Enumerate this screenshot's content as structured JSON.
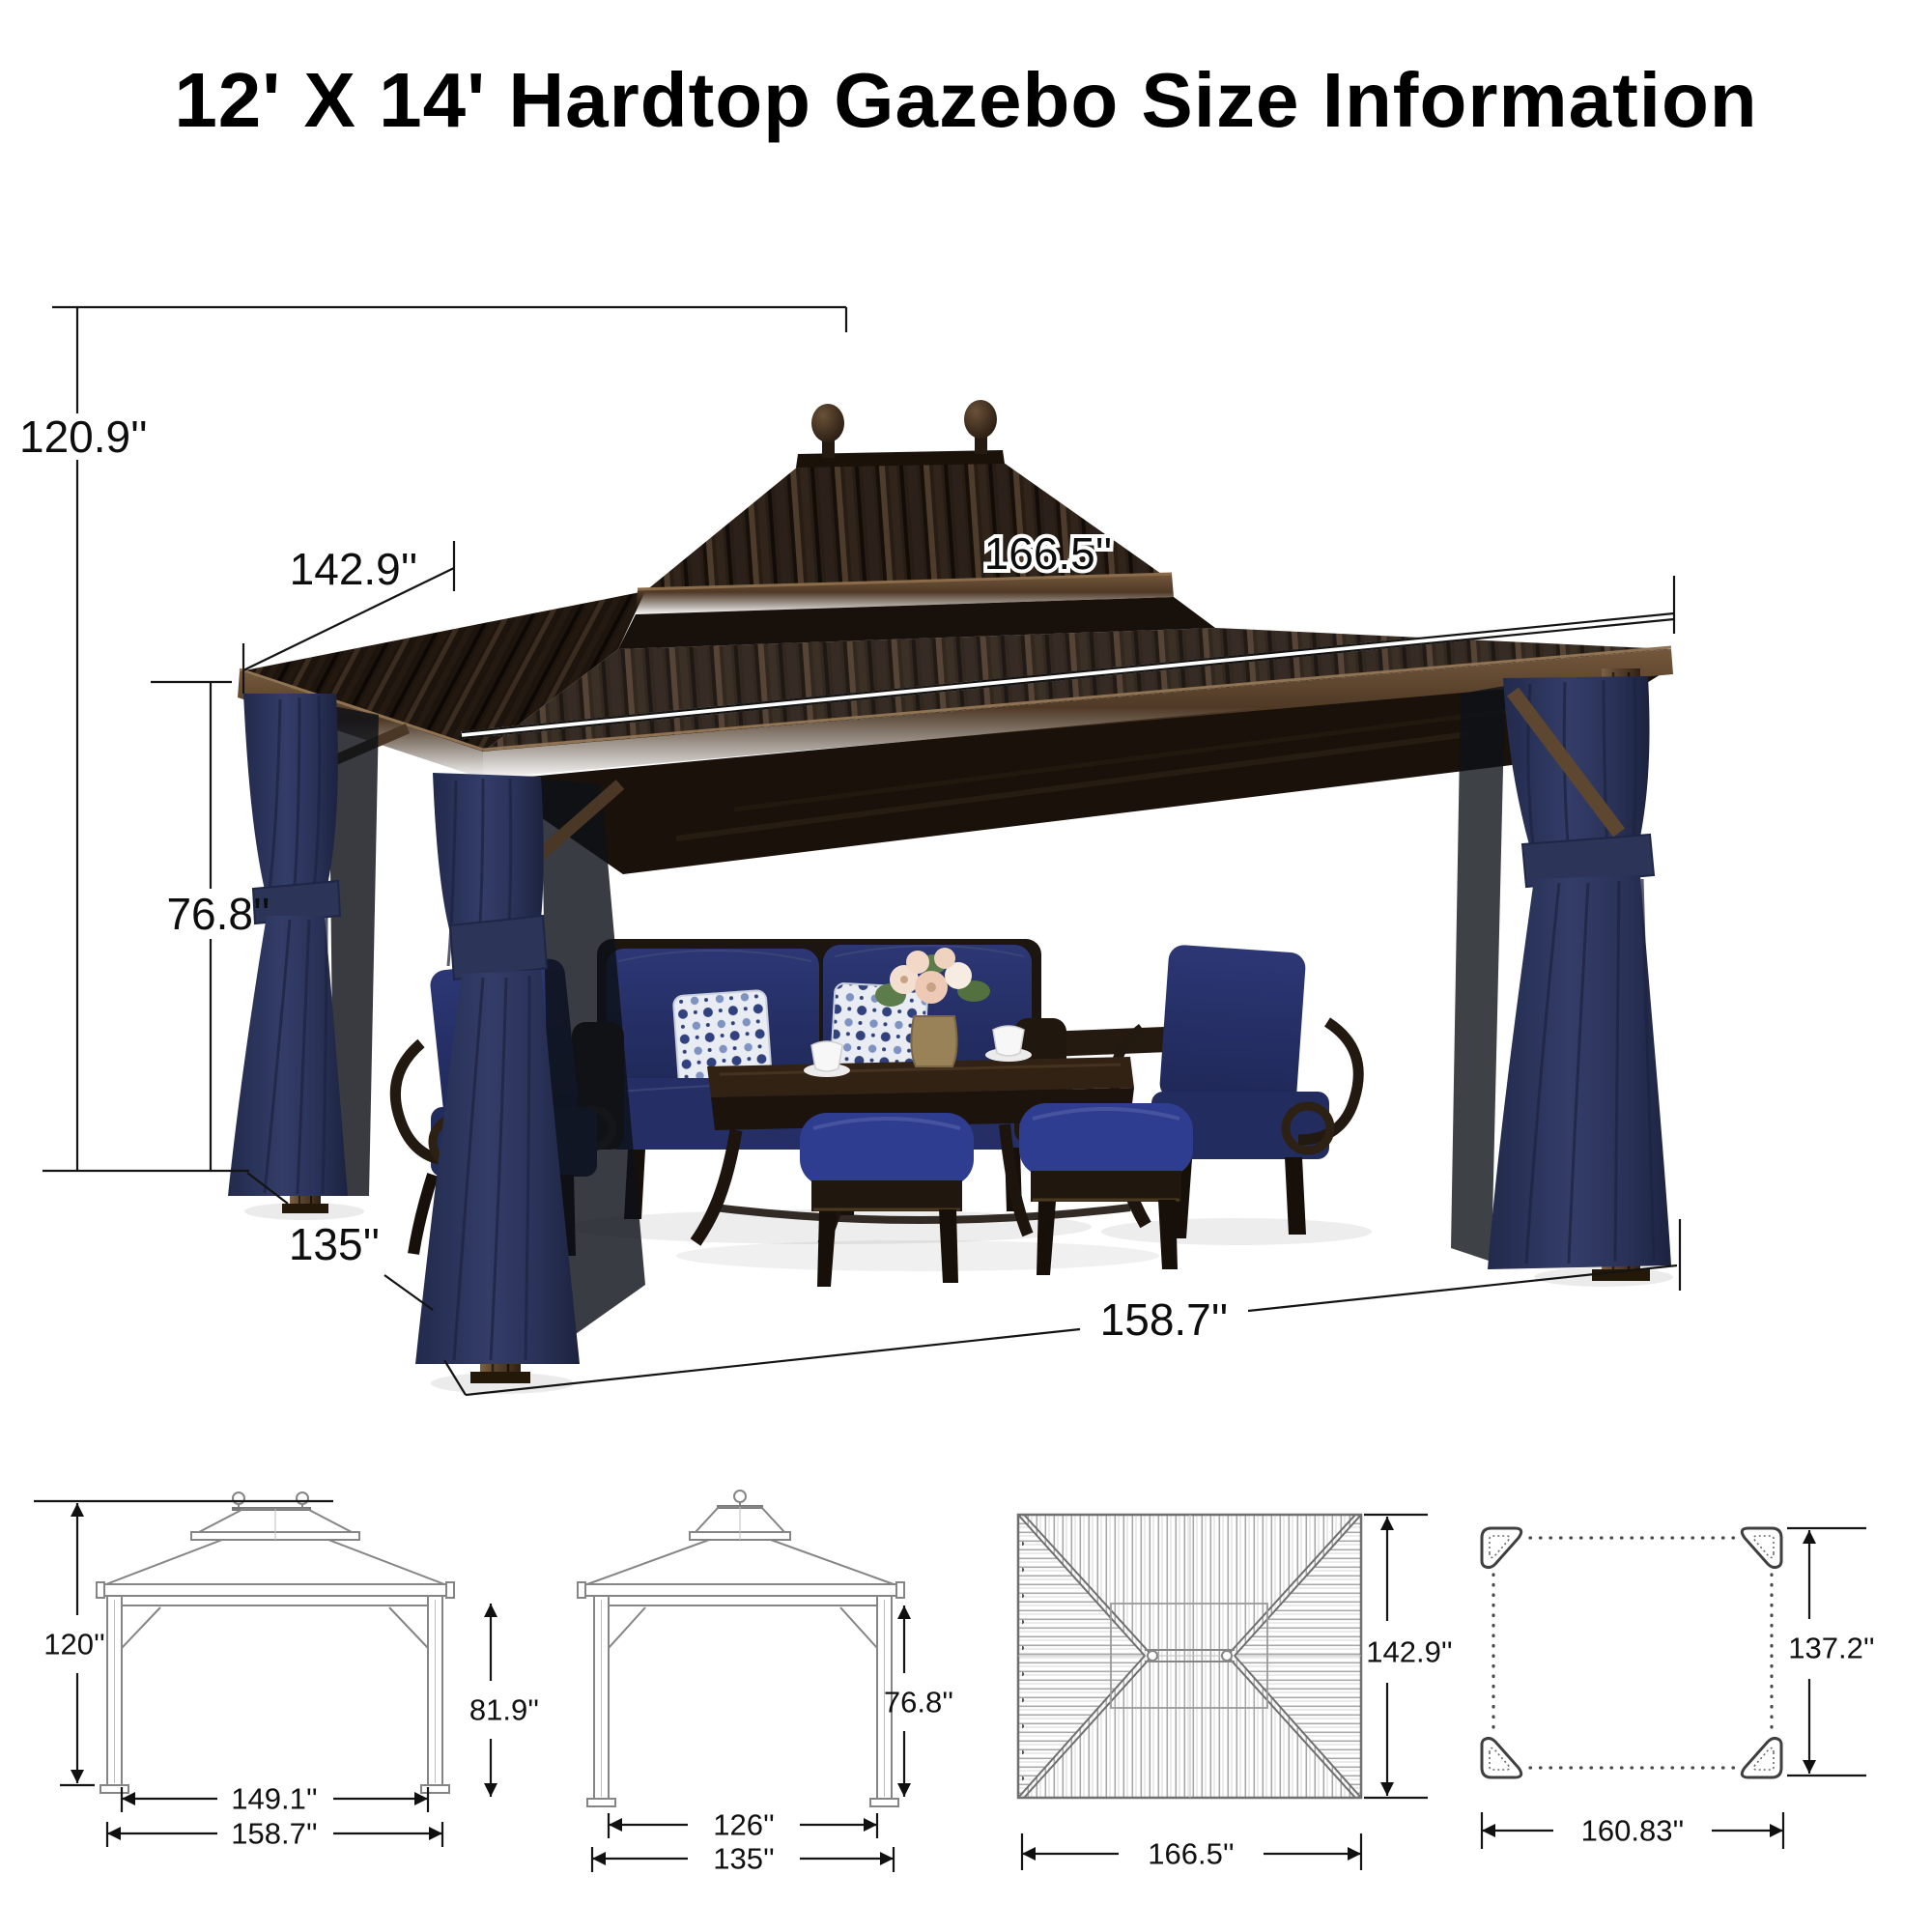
{
  "title": "12' X 14' Hardtop Gazebo Size Information",
  "main_photo": {
    "description": "Brown double-roof hardtop gazebo with navy privacy curtains and a navy cushioned patio seating set",
    "dims": {
      "total_height": "120.9''",
      "roof_side_depth": "142.9''",
      "roof_front_width": "166.5''",
      "post_height": "76.8''",
      "base_side_depth": "135''",
      "base_front_width": "158.7''"
    }
  },
  "diagrams": {
    "front_view": {
      "total_height": "120''",
      "eave_height": "81.9''",
      "inner_width": "149.1''",
      "outer_width": "158.7''"
    },
    "side_view": {
      "post_height": "76.8''",
      "inner_depth": "126''",
      "outer_depth": "135''"
    },
    "roof_plan": {
      "depth": "142.9''",
      "width": "166.5''"
    },
    "base_plan": {
      "depth": "137.2''",
      "width": "160.83''"
    }
  }
}
